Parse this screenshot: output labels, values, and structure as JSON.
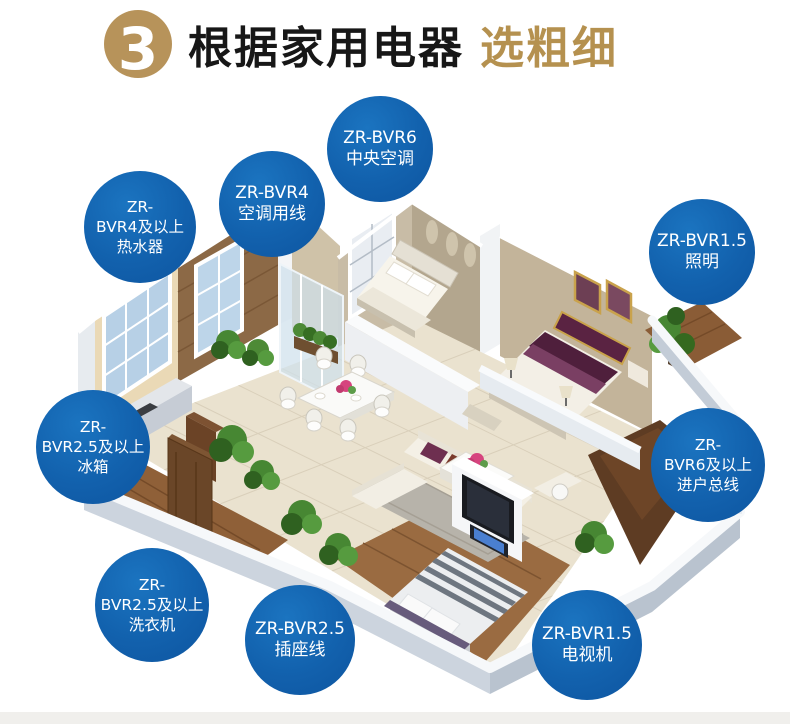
{
  "header": {
    "step_number": "3",
    "title_main": "根据家用电器",
    "title_accent": "选粗细"
  },
  "colors": {
    "badge_blue": "#1261ad",
    "badge_text": "#ffffff",
    "title_dark": "#171717",
    "accent_gold": "#b5914f",
    "step_circle_gold": "#b7935a"
  },
  "badges": [
    {
      "id": "central-air-conditioner",
      "lines": [
        "ZR-BVR6",
        "中央空调"
      ],
      "cx": 380,
      "cy": 149,
      "r": 53
    },
    {
      "id": "air-conditioner-wire",
      "lines": [
        "ZR-BVR4",
        "空调用线"
      ],
      "cx": 272,
      "cy": 204,
      "r": 53
    },
    {
      "id": "water-heater",
      "lines": [
        "ZR-",
        "BVR4及以上",
        "热水器"
      ],
      "cx": 140,
      "cy": 227,
      "r": 56
    },
    {
      "id": "lighting",
      "lines": [
        "ZR-BVR1.5",
        "照明"
      ],
      "cx": 702,
      "cy": 252,
      "r": 53
    },
    {
      "id": "fridge",
      "lines": [
        "ZR-",
        "BVR2.5及以上",
        "冰箱"
      ],
      "cx": 93,
      "cy": 447,
      "r": 57
    },
    {
      "id": "main-incoming-line",
      "lines": [
        "ZR-",
        "BVR6及以上",
        "进户总线"
      ],
      "cx": 708,
      "cy": 465,
      "r": 57
    },
    {
      "id": "washing-machine",
      "lines": [
        "ZR-",
        "BVR2.5及以上",
        "洗衣机"
      ],
      "cx": 152,
      "cy": 605,
      "r": 57
    },
    {
      "id": "socket-wire",
      "lines": [
        "ZR-BVR2.5",
        "插座线"
      ],
      "cx": 300,
      "cy": 640,
      "r": 55
    },
    {
      "id": "tv-set",
      "lines": [
        "ZR-BVR1.5",
        "电视机"
      ],
      "cx": 587,
      "cy": 645,
      "r": 55
    }
  ]
}
